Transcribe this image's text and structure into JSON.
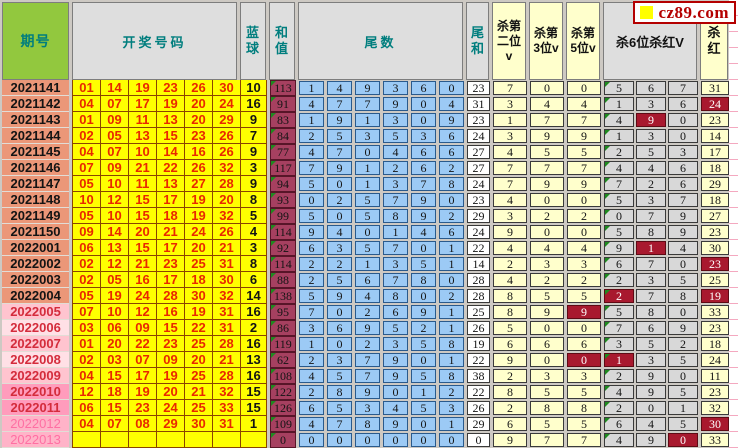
{
  "site": {
    "logo_text": "cz89.com"
  },
  "header": {
    "period": "期号",
    "numbers": "开奖号码",
    "blue": "蓝\n球",
    "sum": "和\n值",
    "tails": "尾数",
    "tail_sum": "尾\n和",
    "kill2": "杀第\n二位\nv",
    "kill3": "杀第\n3位v",
    "kill5": "杀第\n5位v",
    "kill6": "杀6位杀红V",
    "kill_red": "杀\n红"
  },
  "colors": {
    "ball_cell_bg": "#FFFF00",
    "red_ball_text": "#E82800",
    "sum_cell_bg": "#A64060",
    "tail_cell_bg": "#9CCAF5",
    "kill_cell_bg": "#FFFFCC",
    "kill6_cell_bg": "#D8D8D8",
    "highlight_bg": "#A8192E",
    "period_header_bg": "#92C83E",
    "header_text": "#007E7E",
    "salmon_row_bg": "#EB9778",
    "pink_row_bg": "#FFC4CF",
    "hotpink_row_bg": "#FF9CBC"
  },
  "rows": [
    {
      "period": "2021141",
      "tone": "salmon",
      "reds": [
        "01",
        "14",
        "19",
        "23",
        "26",
        "30"
      ],
      "blue": "10",
      "sum": "113",
      "tails": [
        "1",
        "4",
        "9",
        "3",
        "6",
        "0"
      ],
      "tail_sum": "23",
      "k2": "7",
      "k3": "0",
      "k5": "0",
      "k6": [
        "5",
        "6",
        "7"
      ],
      "kr": "31",
      "hl": []
    },
    {
      "period": "2021142",
      "tone": "salmon",
      "reds": [
        "04",
        "07",
        "17",
        "19",
        "20",
        "24"
      ],
      "blue": "16",
      "sum": "91",
      "tails": [
        "4",
        "7",
        "7",
        "9",
        "0",
        "4"
      ],
      "tail_sum": "31",
      "k2": "3",
      "k3": "4",
      "k5": "4",
      "k6": [
        "1",
        "3",
        "6"
      ],
      "kr": "24",
      "hl": [
        "kr"
      ]
    },
    {
      "period": "2021143",
      "tone": "salmon",
      "reds": [
        "01",
        "09",
        "11",
        "13",
        "20",
        "29"
      ],
      "blue": "9",
      "sum": "83",
      "tails": [
        "1",
        "9",
        "1",
        "3",
        "0",
        "9"
      ],
      "tail_sum": "23",
      "k2": "1",
      "k3": "7",
      "k5": "7",
      "k6": [
        "4",
        "9",
        "0"
      ],
      "kr": "23",
      "hl": [
        "k6b"
      ]
    },
    {
      "period": "2021144",
      "tone": "salmon",
      "reds": [
        "02",
        "05",
        "13",
        "15",
        "23",
        "26"
      ],
      "blue": "7",
      "sum": "84",
      "tails": [
        "2",
        "5",
        "3",
        "5",
        "3",
        "6"
      ],
      "tail_sum": "24",
      "k2": "3",
      "k3": "9",
      "k5": "9",
      "k6": [
        "1",
        "3",
        "0"
      ],
      "kr": "14",
      "hl": []
    },
    {
      "period": "2021145",
      "tone": "salmon",
      "reds": [
        "04",
        "07",
        "10",
        "14",
        "16",
        "26"
      ],
      "blue": "9",
      "sum": "77",
      "tails": [
        "4",
        "7",
        "0",
        "4",
        "6",
        "6"
      ],
      "tail_sum": "27",
      "k2": "4",
      "k3": "5",
      "k5": "5",
      "k6": [
        "2",
        "5",
        "3"
      ],
      "kr": "17",
      "hl": []
    },
    {
      "period": "2021146",
      "tone": "salmon",
      "reds": [
        "07",
        "09",
        "21",
        "22",
        "26",
        "32"
      ],
      "blue": "3",
      "sum": "117",
      "tails": [
        "7",
        "9",
        "1",
        "2",
        "6",
        "2"
      ],
      "tail_sum": "27",
      "k2": "7",
      "k3": "7",
      "k5": "7",
      "k6": [
        "4",
        "4",
        "6"
      ],
      "kr": "18",
      "hl": []
    },
    {
      "period": "2021147",
      "tone": "salmon",
      "reds": [
        "05",
        "10",
        "11",
        "13",
        "27",
        "28"
      ],
      "blue": "9",
      "sum": "94",
      "tails": [
        "5",
        "0",
        "1",
        "3",
        "7",
        "8"
      ],
      "tail_sum": "24",
      "k2": "7",
      "k3": "9",
      "k5": "9",
      "k6": [
        "7",
        "2",
        "6"
      ],
      "kr": "29",
      "hl": []
    },
    {
      "period": "2021148",
      "tone": "salmon",
      "reds": [
        "10",
        "12",
        "15",
        "17",
        "19",
        "20"
      ],
      "blue": "8",
      "sum": "93",
      "tails": [
        "0",
        "2",
        "5",
        "7",
        "9",
        "0"
      ],
      "tail_sum": "23",
      "k2": "4",
      "k3": "0",
      "k5": "0",
      "k6": [
        "5",
        "3",
        "7"
      ],
      "kr": "18",
      "hl": []
    },
    {
      "period": "2021149",
      "tone": "salmon",
      "reds": [
        "05",
        "10",
        "15",
        "18",
        "19",
        "32"
      ],
      "blue": "5",
      "sum": "99",
      "tails": [
        "5",
        "0",
        "5",
        "8",
        "9",
        "2"
      ],
      "tail_sum": "29",
      "k2": "3",
      "k3": "2",
      "k5": "2",
      "k6": [
        "0",
        "7",
        "9"
      ],
      "kr": "27",
      "hl": []
    },
    {
      "period": "2021150",
      "tone": "salmon",
      "reds": [
        "09",
        "14",
        "20",
        "21",
        "24",
        "26"
      ],
      "blue": "4",
      "sum": "114",
      "tails": [
        "9",
        "4",
        "0",
        "1",
        "4",
        "6"
      ],
      "tail_sum": "24",
      "k2": "9",
      "k3": "0",
      "k5": "0",
      "k6": [
        "5",
        "8",
        "9"
      ],
      "kr": "23",
      "hl": []
    },
    {
      "period": "2022001",
      "tone": "salmon",
      "reds": [
        "06",
        "13",
        "15",
        "17",
        "20",
        "21"
      ],
      "blue": "3",
      "sum": "92",
      "tails": [
        "6",
        "3",
        "5",
        "7",
        "0",
        "1"
      ],
      "tail_sum": "22",
      "k2": "4",
      "k3": "4",
      "k5": "4",
      "k6": [
        "9",
        "1",
        "4"
      ],
      "kr": "30",
      "hl": [
        "k6b"
      ]
    },
    {
      "period": "2022002",
      "tone": "salmon",
      "reds": [
        "02",
        "12",
        "21",
        "23",
        "25",
        "31"
      ],
      "blue": "8",
      "sum": "114",
      "tails": [
        "2",
        "2",
        "1",
        "3",
        "5",
        "1"
      ],
      "tail_sum": "14",
      "k2": "2",
      "k3": "3",
      "k5": "3",
      "k6": [
        "6",
        "7",
        "0"
      ],
      "kr": "23",
      "hl": [
        "kr"
      ]
    },
    {
      "period": "2022003",
      "tone": "salmon",
      "reds": [
        "02",
        "05",
        "16",
        "17",
        "18",
        "30"
      ],
      "blue": "6",
      "sum": "88",
      "tails": [
        "2",
        "5",
        "6",
        "7",
        "8",
        "0"
      ],
      "tail_sum": "28",
      "k2": "4",
      "k3": "2",
      "k5": "2",
      "k6": [
        "2",
        "3",
        "5"
      ],
      "kr": "25",
      "hl": []
    },
    {
      "period": "2022004",
      "tone": "salmon",
      "reds": [
        "05",
        "19",
        "24",
        "28",
        "30",
        "32"
      ],
      "blue": "14",
      "sum": "138",
      "tails": [
        "5",
        "9",
        "4",
        "8",
        "0",
        "2"
      ],
      "tail_sum": "28",
      "k2": "8",
      "k3": "5",
      "k5": "5",
      "k6": [
        "2",
        "7",
        "8"
      ],
      "kr": "19",
      "hl": [
        "k6a",
        "kr"
      ]
    },
    {
      "period": "2022005",
      "tone": "pink1",
      "reds": [
        "07",
        "10",
        "12",
        "16",
        "19",
        "31"
      ],
      "blue": "16",
      "sum": "95",
      "tails": [
        "7",
        "0",
        "2",
        "6",
        "9",
        "1"
      ],
      "tail_sum": "25",
      "k2": "8",
      "k3": "9",
      "k5": "9",
      "k6": [
        "5",
        "8",
        "0"
      ],
      "kr": "33",
      "hl": [
        "k5"
      ]
    },
    {
      "period": "2022006",
      "tone": "pink2",
      "reds": [
        "03",
        "06",
        "09",
        "15",
        "22",
        "31"
      ],
      "blue": "2",
      "sum": "86",
      "tails": [
        "3",
        "6",
        "9",
        "5",
        "2",
        "1"
      ],
      "tail_sum": "26",
      "k2": "5",
      "k3": "0",
      "k5": "0",
      "k6": [
        "7",
        "6",
        "9"
      ],
      "kr": "23",
      "hl": []
    },
    {
      "period": "2022007",
      "tone": "pink1",
      "reds": [
        "01",
        "20",
        "22",
        "23",
        "25",
        "28"
      ],
      "blue": "16",
      "sum": "119",
      "tails": [
        "1",
        "0",
        "2",
        "3",
        "5",
        "8"
      ],
      "tail_sum": "19",
      "k2": "6",
      "k3": "6",
      "k5": "6",
      "k6": [
        "3",
        "5",
        "2"
      ],
      "kr": "18",
      "hl": []
    },
    {
      "period": "2022008",
      "tone": "pink2",
      "reds": [
        "02",
        "03",
        "07",
        "09",
        "20",
        "21"
      ],
      "blue": "13",
      "sum": "62",
      "tails": [
        "2",
        "3",
        "7",
        "9",
        "0",
        "1"
      ],
      "tail_sum": "22",
      "k2": "9",
      "k3": "0",
      "k5": "0",
      "k6": [
        "1",
        "3",
        "5"
      ],
      "kr": "24",
      "hl": [
        "k5",
        "k6a"
      ]
    },
    {
      "period": "2022009",
      "tone": "pink1",
      "reds": [
        "04",
        "15",
        "17",
        "19",
        "25",
        "28"
      ],
      "blue": "16",
      "sum": "108",
      "tails": [
        "4",
        "5",
        "7",
        "9",
        "5",
        "8"
      ],
      "tail_sum": "38",
      "k2": "2",
      "k3": "3",
      "k5": "3",
      "k6": [
        "2",
        "9",
        "0"
      ],
      "kr": "11",
      "hl": []
    },
    {
      "period": "2022010",
      "tone": "hotpink",
      "reds": [
        "12",
        "18",
        "19",
        "20",
        "21",
        "32"
      ],
      "blue": "15",
      "sum": "122",
      "tails": [
        "2",
        "8",
        "9",
        "0",
        "1",
        "2"
      ],
      "tail_sum": "22",
      "k2": "8",
      "k3": "5",
      "k5": "5",
      "k6": [
        "4",
        "9",
        "5"
      ],
      "kr": "23",
      "hl": []
    },
    {
      "period": "2022011",
      "tone": "hotpink",
      "reds": [
        "06",
        "15",
        "23",
        "24",
        "25",
        "33"
      ],
      "blue": "15",
      "sum": "126",
      "tails": [
        "6",
        "5",
        "3",
        "4",
        "5",
        "3"
      ],
      "tail_sum": "26",
      "k2": "2",
      "k3": "8",
      "k5": "8",
      "k6": [
        "2",
        "0",
        "1"
      ],
      "kr": "32",
      "hl": []
    },
    {
      "period": "2022012",
      "tone": "fadepink",
      "reds": [
        "04",
        "07",
        "08",
        "29",
        "30",
        "31"
      ],
      "blue": "1",
      "sum": "109",
      "tails": [
        "4",
        "7",
        "8",
        "9",
        "0",
        "1"
      ],
      "tail_sum": "29",
      "k2": "6",
      "k3": "5",
      "k5": "5",
      "k6": [
        "6",
        "4",
        "5"
      ],
      "kr": "30",
      "hl": [
        "kr"
      ]
    },
    {
      "period": "2022013",
      "tone": "fadepink",
      "reds": [
        "",
        "",
        "",
        "",
        "",
        ""
      ],
      "blue": "",
      "sum": "0",
      "tails": [
        "0",
        "0",
        "0",
        "0",
        "0",
        "0"
      ],
      "tail_sum": "0",
      "k2": "9",
      "k3": "7",
      "k5": "7",
      "k6": [
        "4",
        "9",
        "0"
      ],
      "kr": "33",
      "hl": [
        "k6c"
      ]
    }
  ]
}
